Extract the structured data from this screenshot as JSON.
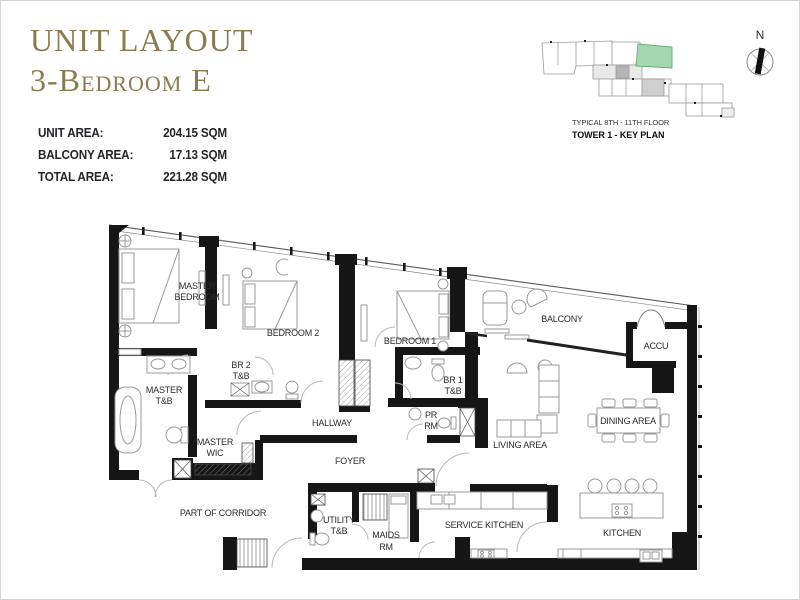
{
  "title": {
    "line1": "UNIT LAYOUT",
    "line2": "3-Bedroom E",
    "color": "#8b7b50"
  },
  "areas": {
    "rows": [
      {
        "label": "UNIT AREA:",
        "value": "204.15 SQM"
      },
      {
        "label": "BALCONY AREA:",
        "value": "17.13 SQM"
      },
      {
        "label": "TOTAL AREA:",
        "value": "221.28 SQM"
      }
    ]
  },
  "key_plan": {
    "caption_line1": "TYPICAL 8TH - 11TH FLOOR",
    "caption_line2": "TOWER 1 - KEY PLAN",
    "highlight_color": "#a5d7ae",
    "north_label": "N"
  },
  "floor_plan": {
    "wall_color": "#161616",
    "furniture_color": "#9a9a9a",
    "rooms": {
      "master_bedroom_l1": "MASTER",
      "master_bedroom_l2": "BEDROOM",
      "bedroom2": "BEDROOM 2",
      "bedroom1": "BEDROOM 1",
      "balcony": "BALCONY",
      "accu": "ACCU",
      "br2_tb_l1": "BR 2",
      "br2_tb_l2": "T&B",
      "br1_tb_l1": "BR 1",
      "br1_tb_l2": "T&B",
      "master_tb_l1": "MASTER",
      "master_tb_l2": "T&B",
      "master_wic_l1": "MASTER",
      "master_wic_l2": "WIC",
      "hallway": "HALLWAY",
      "pr_rm_l1": "PR",
      "pr_rm_l2": "RM",
      "living_area": "LIVING AREA",
      "dining_area": "DINING AREA",
      "foyer": "FOYER",
      "part_of_corridor": "PART OF CORRIDOR",
      "utility_tb_l1": "UTILITY",
      "utility_tb_l2": "T&B",
      "maids_rm_l1": "MAIDS",
      "maids_rm_l2": "RM",
      "service_kitchen": "SERVICE KITCHEN",
      "kitchen": "KITCHEN"
    }
  }
}
